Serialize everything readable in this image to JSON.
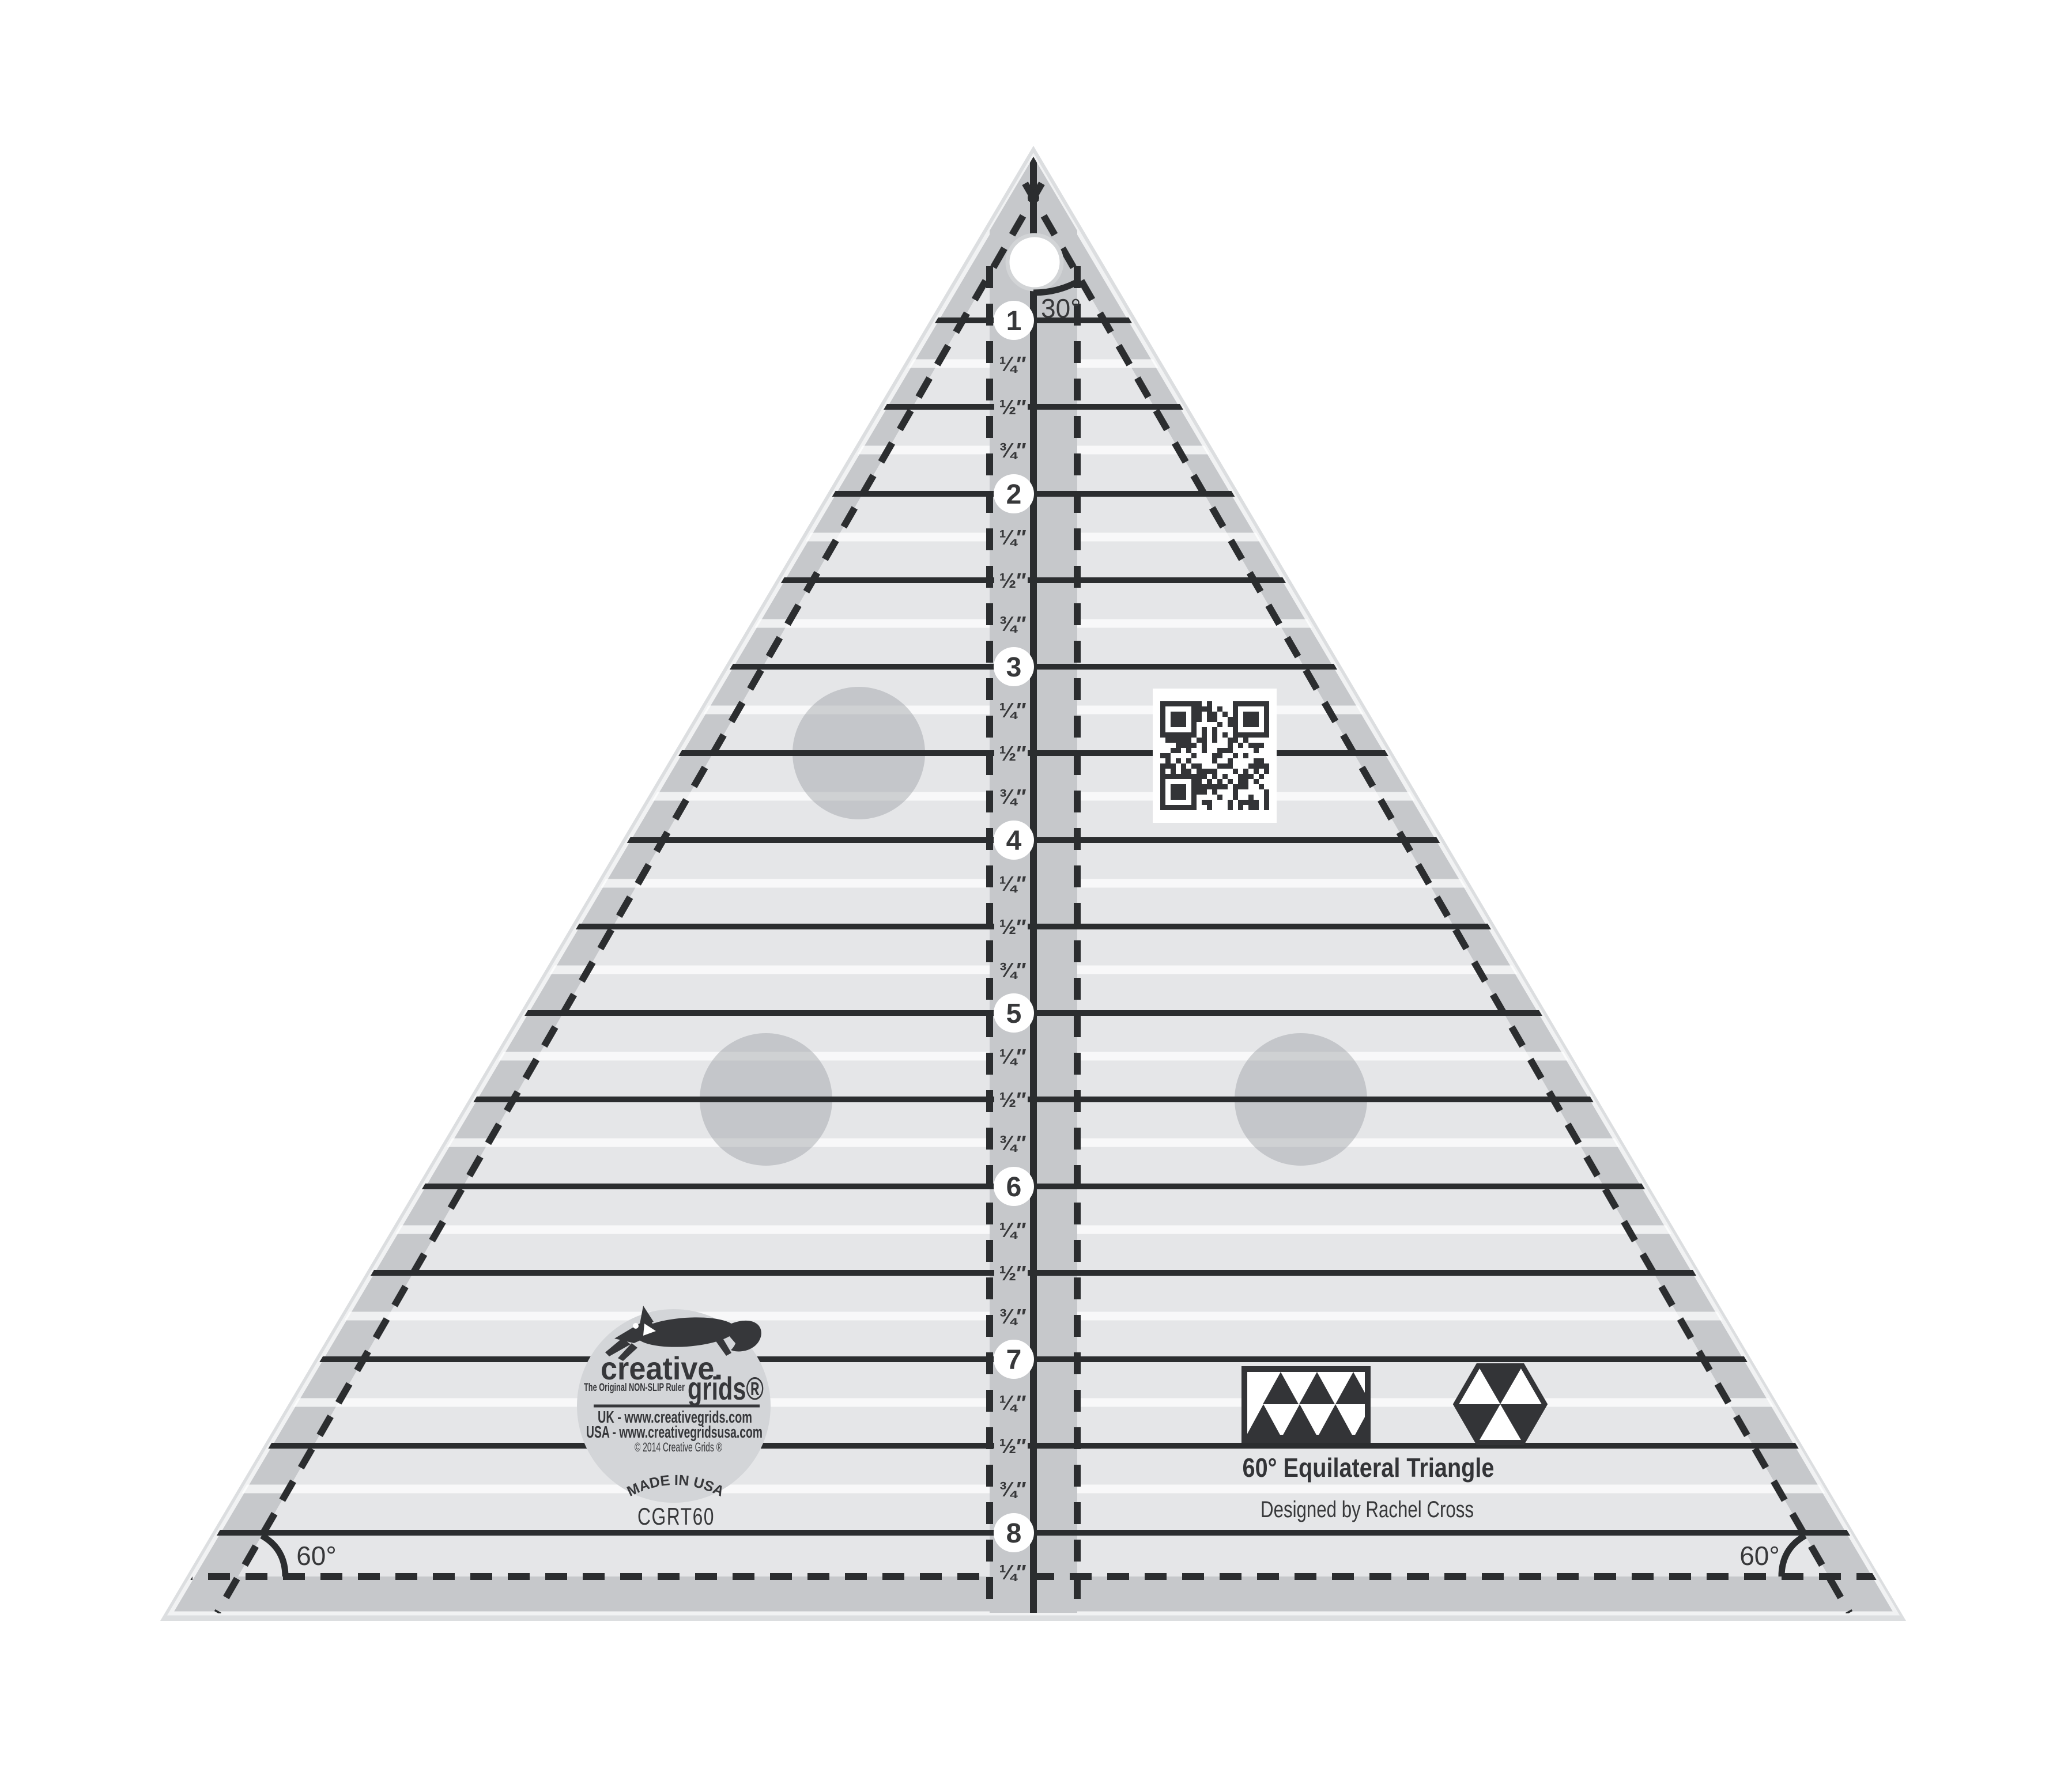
{
  "ruler": {
    "description": "60 degree equilateral triangle quilting ruler product image",
    "apex_angle_label": "30°",
    "bottom_left_angle_label": "60°",
    "bottom_right_angle_label": "60°",
    "inch_numbers": [
      "1",
      "2",
      "3",
      "4",
      "5",
      "6",
      "7",
      "8"
    ],
    "fraction_labels": [
      "¼″",
      "½″",
      "¾″"
    ],
    "bottom_fraction_label": "¼″",
    "colors": {
      "edge": "#dcdee0",
      "band": "#c6c8cb",
      "body": "#e5e6e8",
      "line": "#2b2d2f",
      "text": "#37383a",
      "logo_circle": "#d3d5d8",
      "hole_ring": "#d2d4d6"
    }
  },
  "logo": {
    "brand_top": "creative.",
    "brand_bottom": "grids®",
    "tagline": "The Original NON-SLIP Ruler",
    "url_uk": "UK - www.creativegrids.com",
    "url_usa": "USA - www.creativegridsusa.com",
    "copyright": "© 2014 Creative Grids ®",
    "made_in": "MADE IN USA"
  },
  "product": {
    "model": "CGRT60",
    "title": "60° Equilateral Triangle",
    "designer": "Designed by Rachel Cross"
  },
  "icons": [
    "fox-logo-icon",
    "qr-code",
    "triangle-pattern-icon",
    "hexagon-triangles-icon",
    "hang-hole"
  ]
}
